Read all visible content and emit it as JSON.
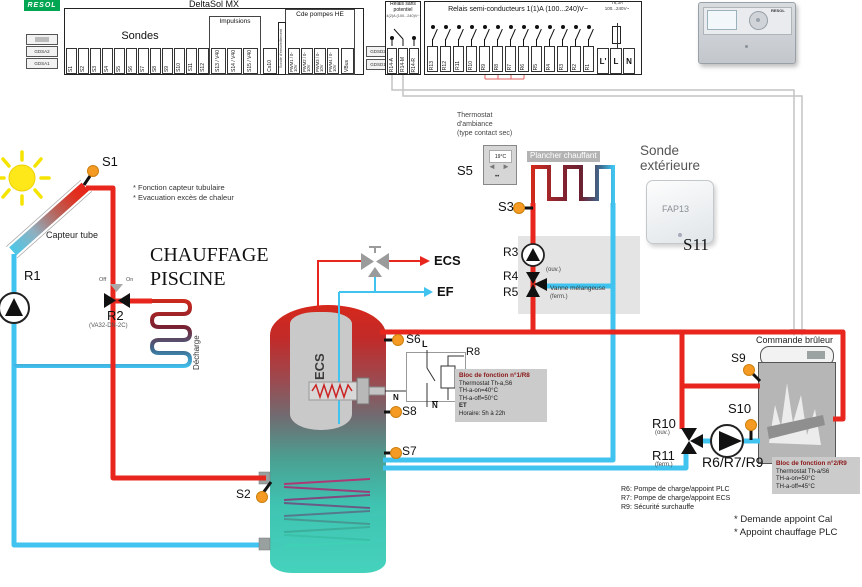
{
  "colors": {
    "pipe_red": "#e8261d",
    "pipe_cyan": "#41c3f0",
    "sensor_orange": "#f59a23",
    "brand_green": "#00a651"
  },
  "strip": {
    "brand": "RESOL",
    "title": "DeltaSol MX",
    "left_modules": [
      "GDSA2",
      "GDSA1"
    ],
    "sondes_label": "Sondes",
    "sondes": [
      "S1",
      "S2",
      "S3",
      "S4",
      "S5",
      "S6",
      "S7",
      "S8",
      "S9",
      "S10",
      "S11",
      "S12"
    ],
    "impulsions_label": "Impulsions",
    "impulsions": [
      "S13 / V40",
      "S14 / V40",
      "S15 / V40"
    ],
    "cs10": "Cs10",
    "cs10_note": "Sonde d'ensoleillement",
    "cde_label": "Cde pompes HE",
    "pwm": [
      "PWM1 / 0-10V",
      "PWM2 / 0-10V",
      "PWM3 / 0-10V",
      "PWM4 / 0-10V"
    ],
    "vbus": "VBus",
    "gdsd": [
      "GDSD2",
      "GDSD1"
    ],
    "relais_sans": {
      "l1": "Relais sans",
      "l2": "potentiel",
      "l3": "4(2)A (100...240)V~",
      "terminals": [
        "R14-A",
        "R14-M",
        "R14-R"
      ]
    },
    "semi_label": "Relais semi-conducteurs 1(1)A (100...240)V~",
    "semi": [
      "R13",
      "R12",
      "R11",
      "R10",
      "R9",
      "R8",
      "R7",
      "R6",
      "R5",
      "R4",
      "R3",
      "R2",
      "R1"
    ],
    "power": [
      "L'",
      "L",
      "N"
    ],
    "fuse": [
      "T6,3A",
      "100...240V~"
    ]
  },
  "controller": {
    "brand": "RESOL"
  },
  "solar": {
    "s1": "S1",
    "collector": "Capteur tube",
    "notes": [
      "* Fonction capteur tubulaire",
      "* Evacuation excès de chaleur"
    ],
    "r1": "R1"
  },
  "piscine": {
    "title1": "CHAUFFAGE",
    "title2": "PISCINE",
    "r2": "R2",
    "r2_model": "(VA32-DN-2C)",
    "off": "Off",
    "on": "On",
    "decharge": "Décharge"
  },
  "ambiance": {
    "l1": "Thermostat",
    "l2": "d'ambiance",
    "l3": "(type contact sec)",
    "s5": "S5",
    "temp": "19°C"
  },
  "plancher": {
    "label": "Plancher chauffant",
    "s3": "S3"
  },
  "exterieur": {
    "l1": "Sonde",
    "l2": "extérieure",
    "device": "FAP13",
    "s11": "S11"
  },
  "mix": {
    "r3": "R3",
    "r4": "R4",
    "r4_note": "(ouv.)",
    "r5": "R5",
    "valve": "Vanne mélangeuse",
    "r5_note": "(ferm.)"
  },
  "eau": {
    "ecs": "ECS",
    "ef": "EF"
  },
  "tank": {
    "label": "ECS",
    "s6": "S6",
    "s8": "S8",
    "s7": "S7",
    "s2": "S2"
  },
  "r8": {
    "label": "R8",
    "l": "L",
    "n_left": "N",
    "n_bottom": "N"
  },
  "bloc1": {
    "title": "Bloc de fonction n°1/R8",
    "lines": [
      "Thermostat Th-a,S6",
      "TH-a-on=40°C",
      "TH-a-off=50°C"
    ],
    "et": "ET",
    "horaire": "Horaire: 5h à 22h"
  },
  "chaudiere": {
    "commande": "Commande brûleur",
    "s9": "S9",
    "s10": "S10",
    "r10": "R10",
    "r10_note": "(ouv.)",
    "r11": "R11",
    "r11_note": "(ferm.)",
    "pump": "R6/R7/R9"
  },
  "bloc2": {
    "title": "Bloc de fonction n°2/R9",
    "lines": [
      "Thermostat Th-a/S6",
      "TH-a-on=50°C",
      "TH-a-off=45°C"
    ]
  },
  "legend": [
    "R6: Pompe de charge/appoint PLC",
    "R7: Pompe de charge/appoint ECS",
    "R9: Sécurité surchauffe"
  ],
  "footnotes": [
    "* Demande appoint Cal",
    "* Appoint chauffage PLC"
  ]
}
